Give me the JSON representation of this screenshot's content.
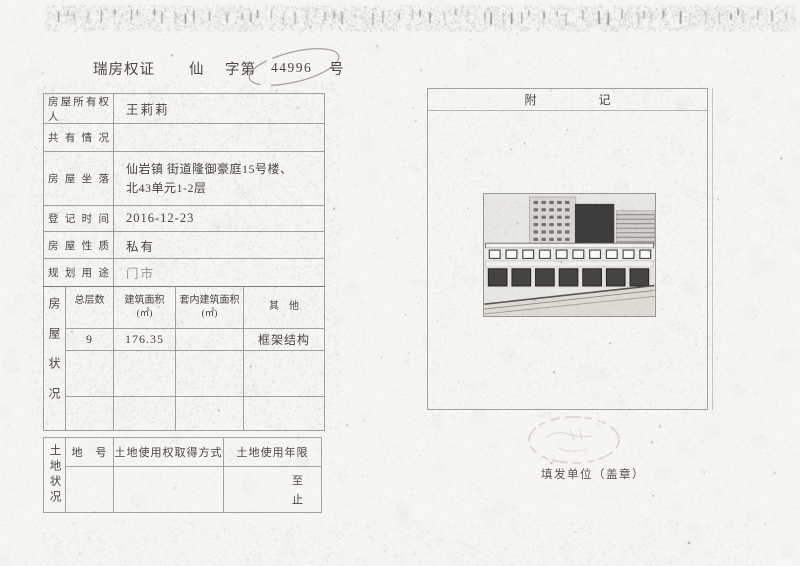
{
  "colors": {
    "paper": "#f6f5f2",
    "ink": "#3c3c3c",
    "line": "#707070"
  },
  "title": {
    "prefix": "瑞房权证",
    "zone": "仙",
    "word": "字第",
    "number": "44996",
    "suffix": "号"
  },
  "fields": [
    {
      "label": "房屋所有权人",
      "value": "王莉莉"
    },
    {
      "label": "共有情况",
      "value": ""
    },
    {
      "label": "房屋坐落",
      "value_line1": "仙岩镇 街道隆御豪庭15号楼、",
      "value_line2": "北43单元1-2层"
    },
    {
      "label": "登记时间",
      "value": "2016-12-23"
    },
    {
      "label": "房屋性质",
      "value": "私有"
    },
    {
      "label": "规划用途",
      "value": "门市"
    }
  ],
  "house_table": {
    "side_label": "房屋状况",
    "columns": [
      {
        "line1": "总层数",
        "line2": ""
      },
      {
        "line1": "建筑面积",
        "line2": "(㎡)"
      },
      {
        "line1": "套内建筑面积",
        "line2": "(㎡)"
      },
      {
        "line1": "其　他",
        "line2": ""
      }
    ],
    "row": {
      "floors": "9",
      "area": "176.35",
      "inner_area": "",
      "other": "框架结构"
    }
  },
  "land_table": {
    "side_label": "土地状况",
    "headers": [
      "地　号",
      "土地使用权取得方式",
      "土地使用年限"
    ],
    "term": {
      "to": "至",
      "end": "止"
    }
  },
  "annex": {
    "char1": "附",
    "char2": "记"
  },
  "issuer": {
    "label": "填发单位（盖章）"
  }
}
